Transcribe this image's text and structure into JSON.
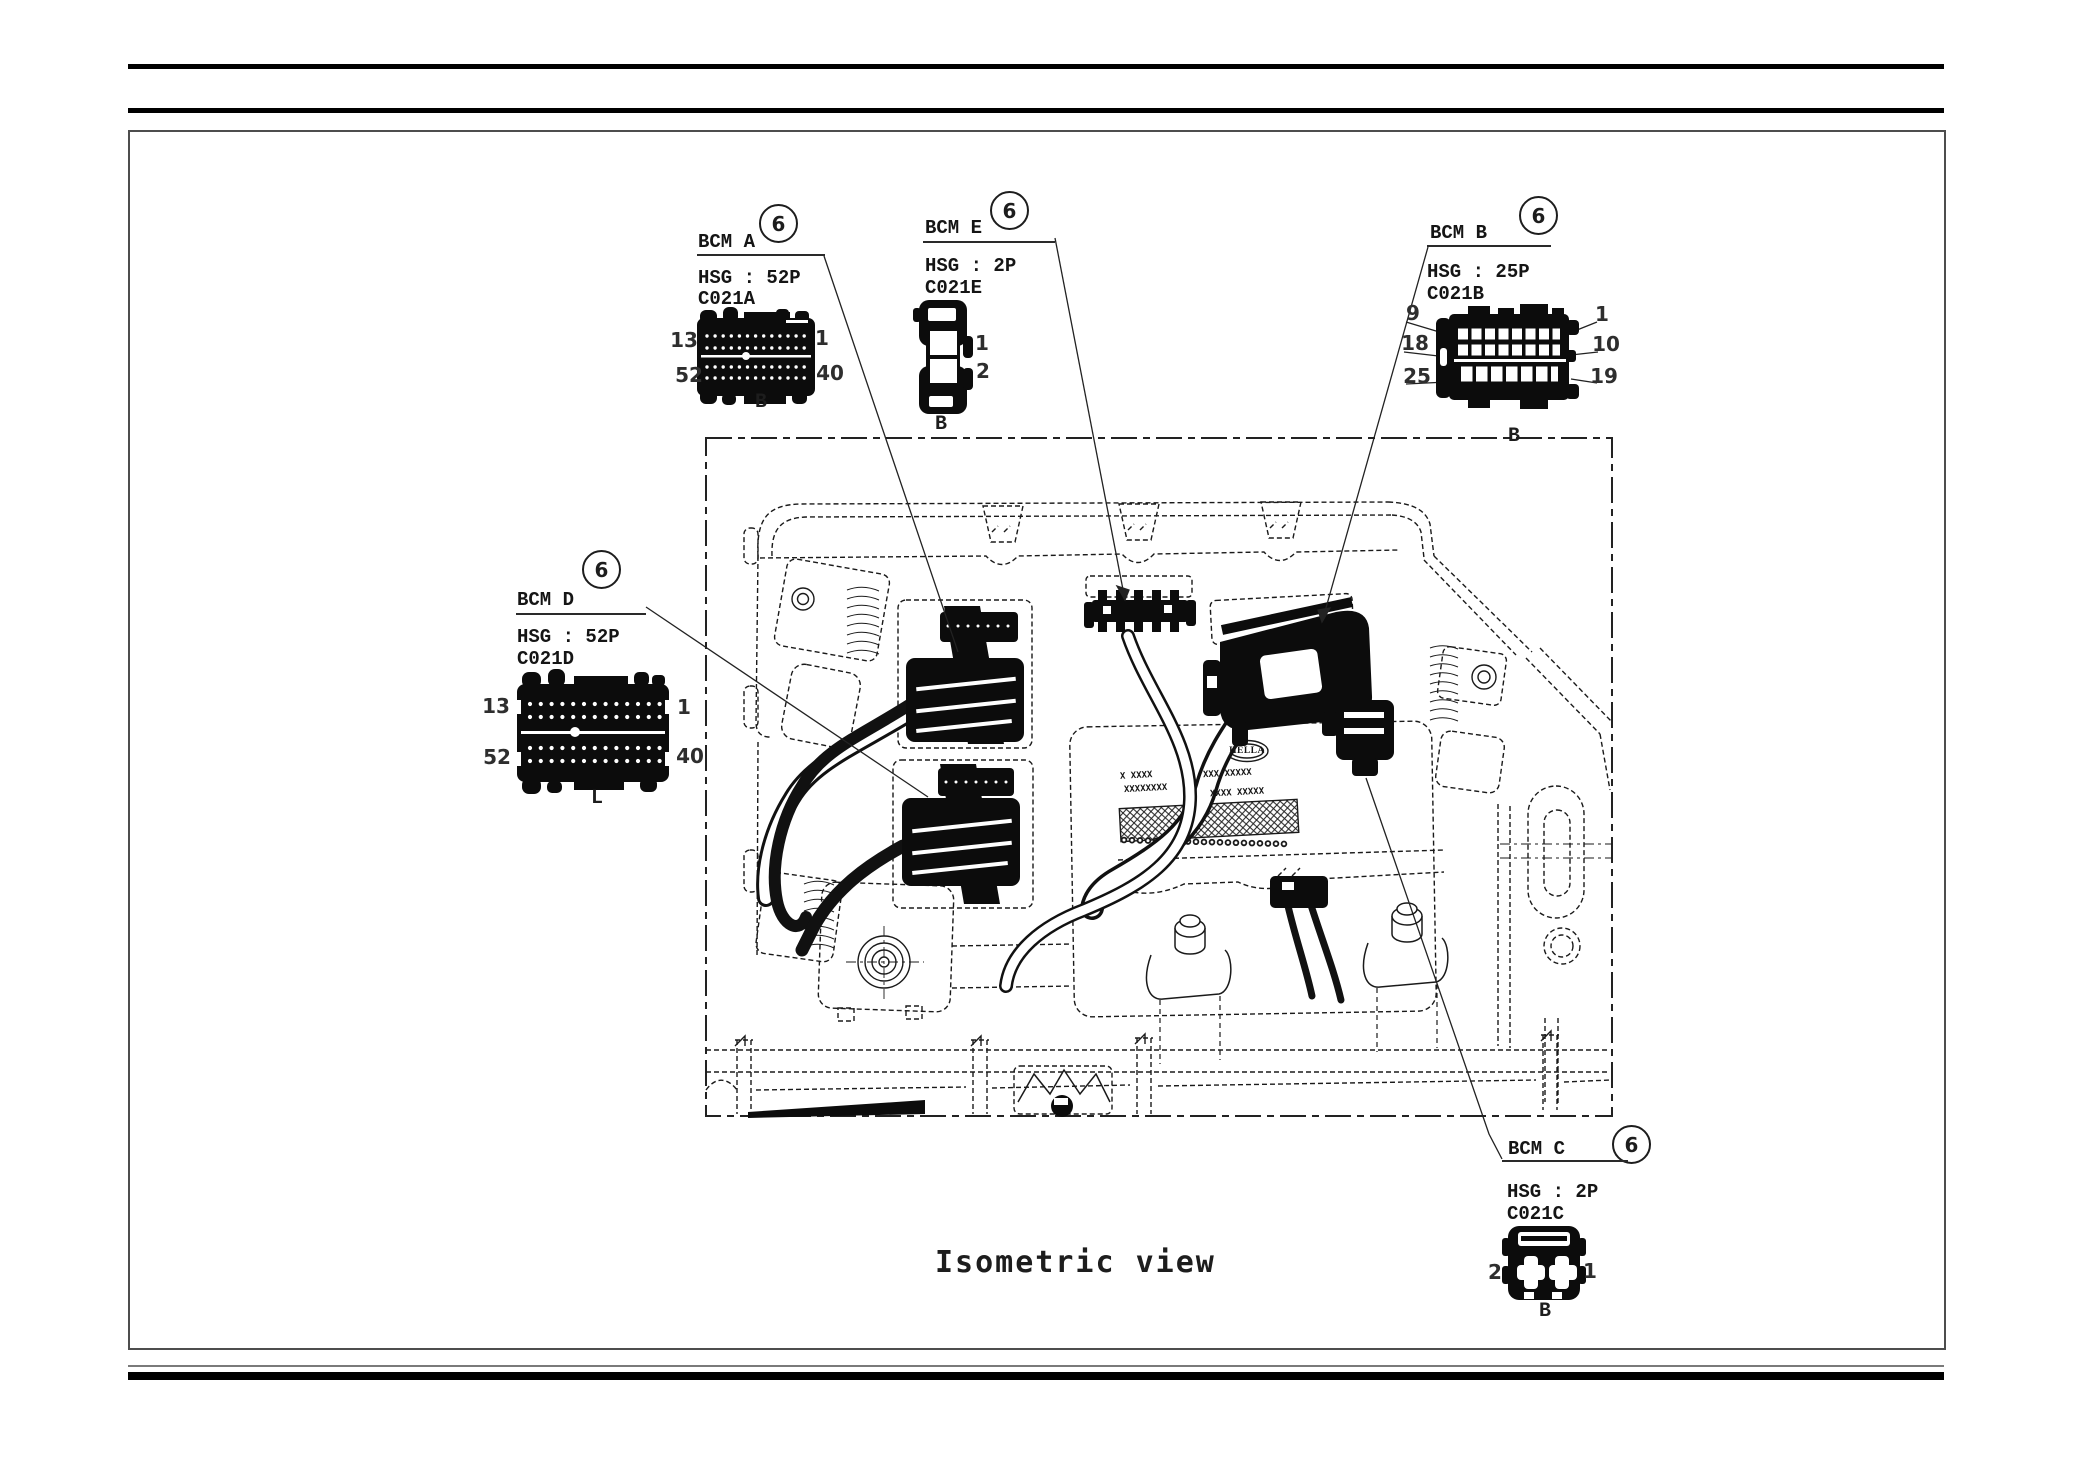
{
  "page": {
    "caption": "Isometric view"
  },
  "colors": {
    "ink": "#1a1a1a",
    "background": "#ffffff"
  },
  "callouts": {
    "a": {
      "label": "BCM A",
      "index": "6",
      "hsg": "HSG : 52P",
      "code": "C021A",
      "pin_top_left": "13",
      "pin_top_right": "1",
      "pin_bottom_left": "52",
      "pin_bottom_right": "40",
      "row_letter": "B"
    },
    "e": {
      "label": "BCM E",
      "index": "6",
      "hsg": "HSG : 2P",
      "code": "C021E",
      "pin_1": "1",
      "pin_2": "2",
      "row_letter": "B"
    },
    "b": {
      "label": "BCM B",
      "index": "6",
      "hsg": "HSG : 25P",
      "code": "C021B",
      "pin_top_left": "9",
      "pin_top_right": "1",
      "pin_mid_left": "18",
      "pin_mid_right": "10",
      "pin_bottom_left": "25",
      "pin_bottom_right": "19",
      "row_letter": "B"
    },
    "d": {
      "label": "BCM D",
      "index": "6",
      "hsg": "HSG : 52P",
      "code": "C021D",
      "pin_top_left": "13",
      "pin_top_right": "1",
      "pin_bottom_left": "52",
      "pin_bottom_right": "40",
      "row_letter": "L"
    },
    "c": {
      "label": "BCM C",
      "index": "6",
      "hsg": "HSG : 2P",
      "code": "C021C",
      "pin_left": "2",
      "pin_right": "1",
      "row_letter": "B"
    }
  },
  "drawing": {
    "logo": "HELLA",
    "plate_lines": [
      "X XXXX",
      "XXXXXXXX",
      "XXX XXXXX",
      "XXXX XXXXX"
    ]
  }
}
